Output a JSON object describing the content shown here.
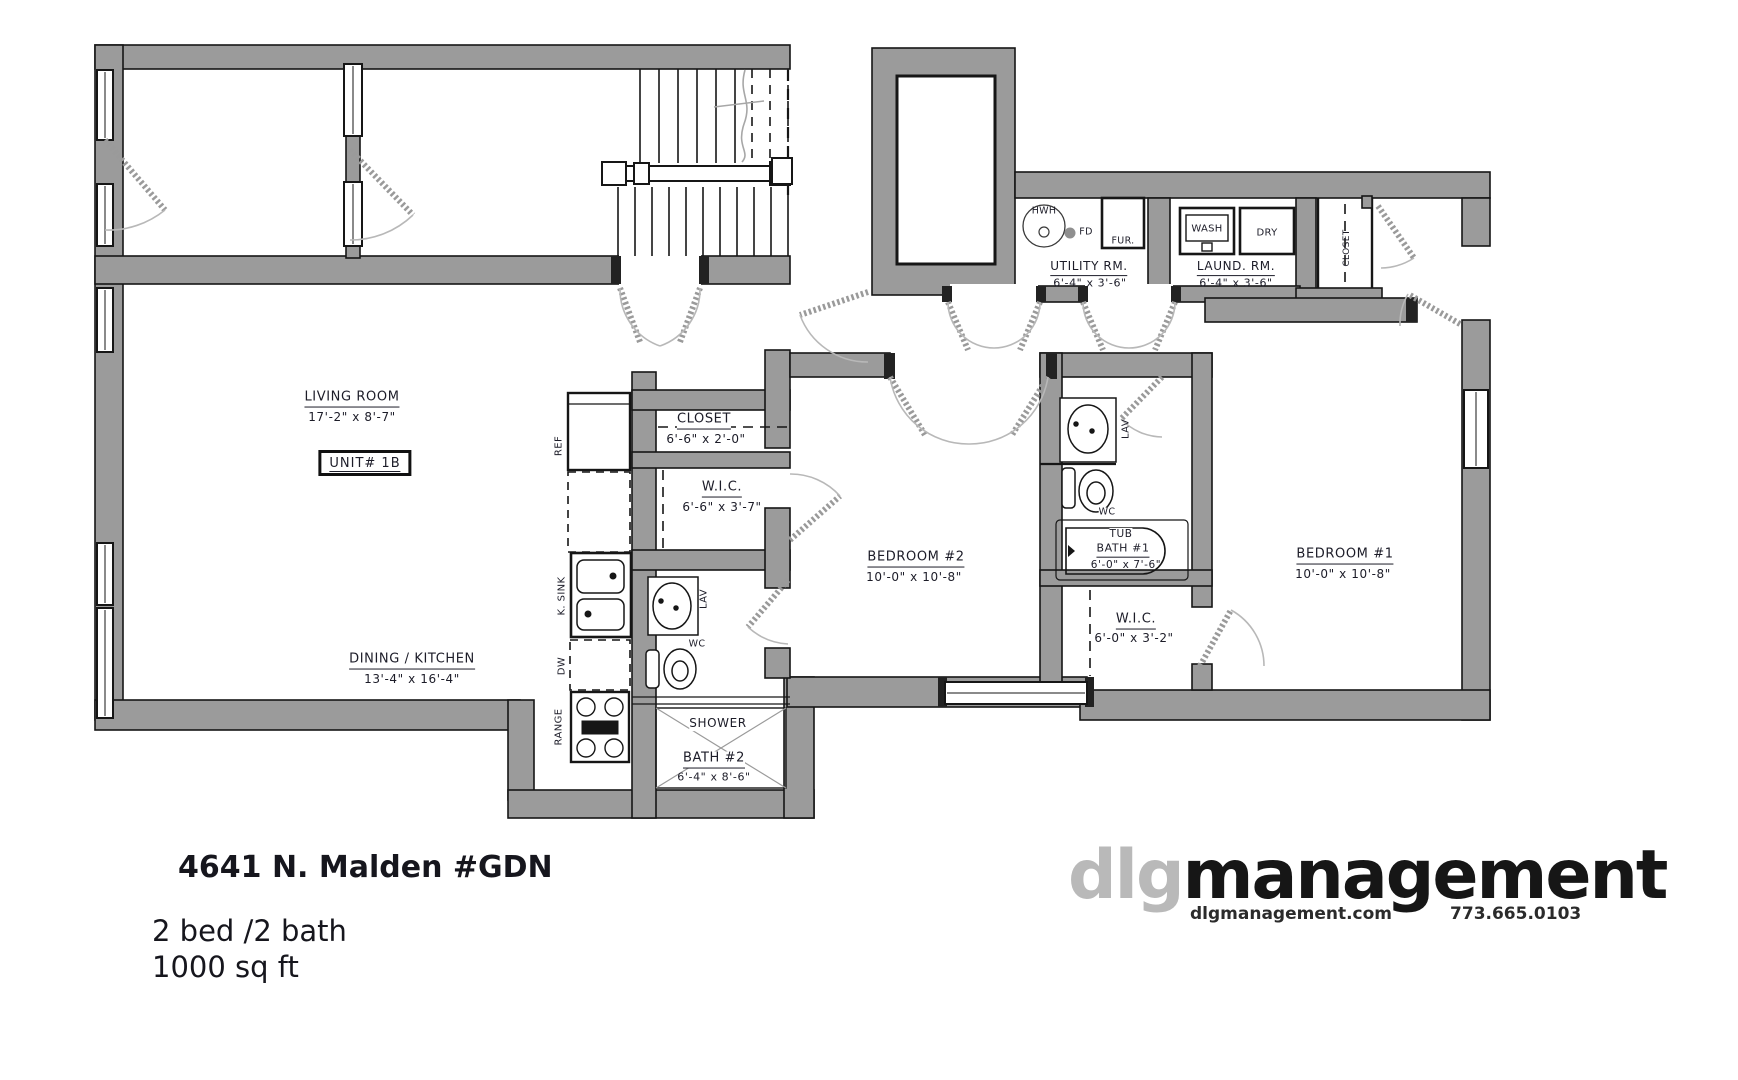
{
  "floor_plan": {
    "rooms": {
      "living_room": {
        "name": "LIVING ROOM",
        "dims": "17'-2\" x 8'-7\""
      },
      "unit_label": "UNIT# 1B",
      "dining_kitchen": {
        "name": "DINING / KITCHEN",
        "dims": "13'-4\" x 16'-4\""
      },
      "closet_main": {
        "name": "CLOSET",
        "dims": "6'-6\" x 2'-0\""
      },
      "wic_main": {
        "name": "W.I.C.",
        "dims": "6'-6\" x 3'-7\""
      },
      "bath2": {
        "name": "BATH #2",
        "dims": "6'-4\" x 8'-6\"",
        "shower": "SHOWER"
      },
      "bedroom2": {
        "name": "BEDROOM #2",
        "dims": "10'-0\" x 10'-8\""
      },
      "bath1": {
        "name": "BATH #1",
        "dims": "6'-0\" x 7'-6\"",
        "tub": "TUB"
      },
      "wic_bedroom1": {
        "name": "W.I.C.",
        "dims": "6'-0\" x 3'-2\""
      },
      "bedroom1": {
        "name": "BEDROOM #1",
        "dims": "10'-0\" x 10'-8\""
      },
      "utility": {
        "name": "UTILITY RM.",
        "dims": "6'-4\" x 3'-6\""
      },
      "laundry": {
        "name": "LAUND. RM.",
        "dims": "6'-4\" x 3'-6\""
      },
      "closet_entry": "CLOSET"
    },
    "fixtures": {
      "ref": "REF",
      "k_sink": "K. SINK",
      "dw": "DW",
      "range": "RANGE",
      "lav_bath2": "LAV",
      "wc_bath2": "WC",
      "lav_bath1": "LAV",
      "wc_bath1": "WC",
      "hwh": "HWH",
      "fd": "FD",
      "furnace": "FUR.",
      "washer": "WASH",
      "dryer": "DRY"
    }
  },
  "footer": {
    "address": "4641 N. Malden #GDN",
    "bed_bath": "2 bed /2 bath",
    "area": "1000 sq ft"
  },
  "logo": {
    "prefix": "dlg",
    "suffix": "management",
    "website": "dlgmanagement.com",
    "phone": "773.665.0103"
  },
  "colors": {
    "wall": "#9b9b9b",
    "line": "#161616",
    "label": "#1c1c28",
    "logo_gray": "#b9b9b9"
  }
}
